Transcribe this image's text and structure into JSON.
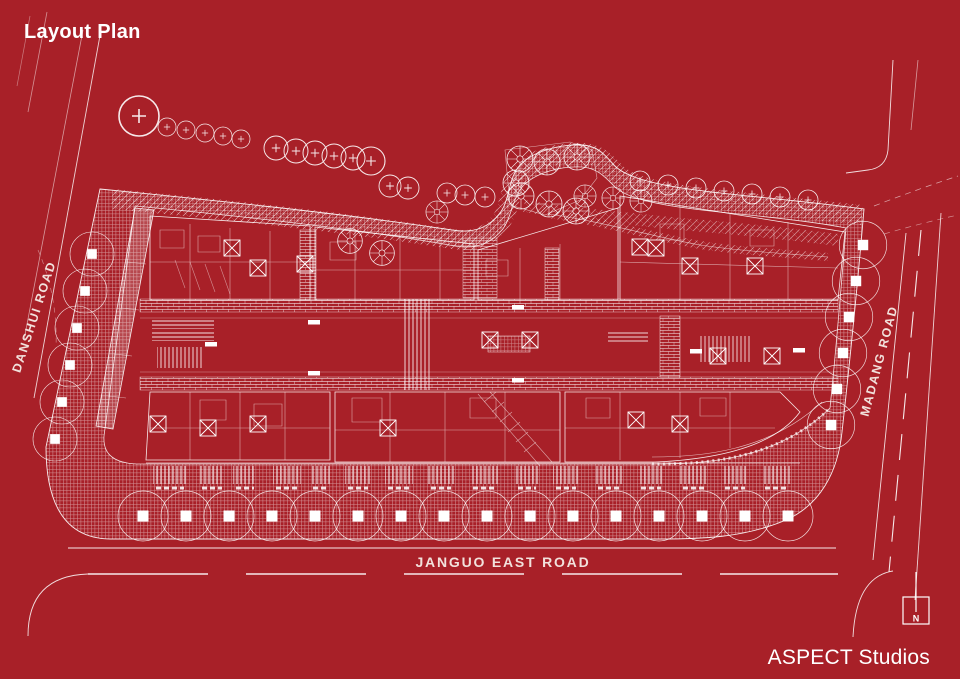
{
  "header": {
    "title": "Layout Plan"
  },
  "footer": {
    "credit": "ASPECT Studios"
  },
  "plan": {
    "roads": {
      "west_label": "DANSHUI ROAD",
      "east_label": "MADANG ROAD",
      "south_label": "JANGUO EAST ROAD"
    },
    "north_indicator_label": "N"
  },
  "colors": {
    "background": "#A82028",
    "linework": "#FFFFFF",
    "road_label_text": "#F2E1DC"
  }
}
